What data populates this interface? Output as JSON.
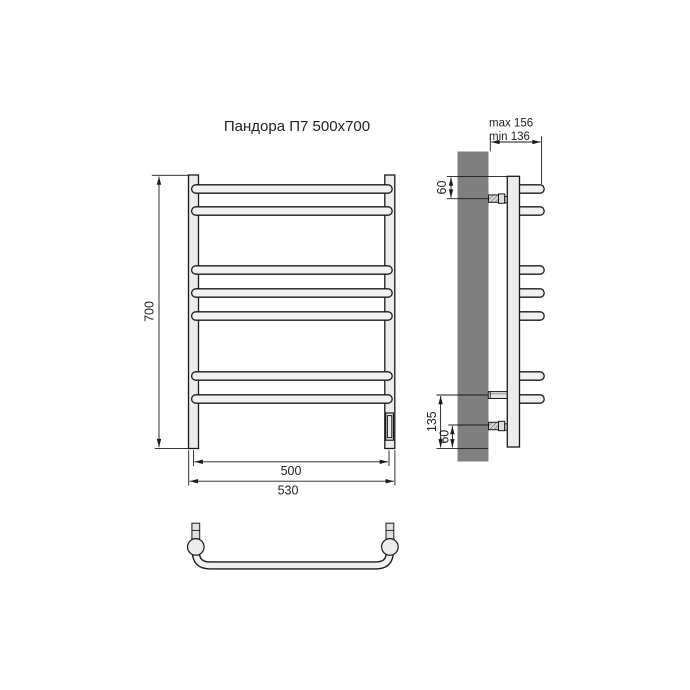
{
  "title": "Пандора П7 500x700",
  "colors": {
    "background": "#ffffff",
    "wall": "#7f7f7f",
    "metal_light": "#ececec",
    "line": "#1a1a1a"
  },
  "front_view": {
    "rungs_count": 7,
    "height_dim": "700",
    "axle_distance_dim": "500",
    "overall_width_dim": "530"
  },
  "side_view": {
    "depth_max_dim": "max 156",
    "depth_min_dim": "min 136",
    "top_mount_offset_dim": "60",
    "bottom_mount_height_dim": "135",
    "bottom_mount_offset_dim": "60"
  }
}
